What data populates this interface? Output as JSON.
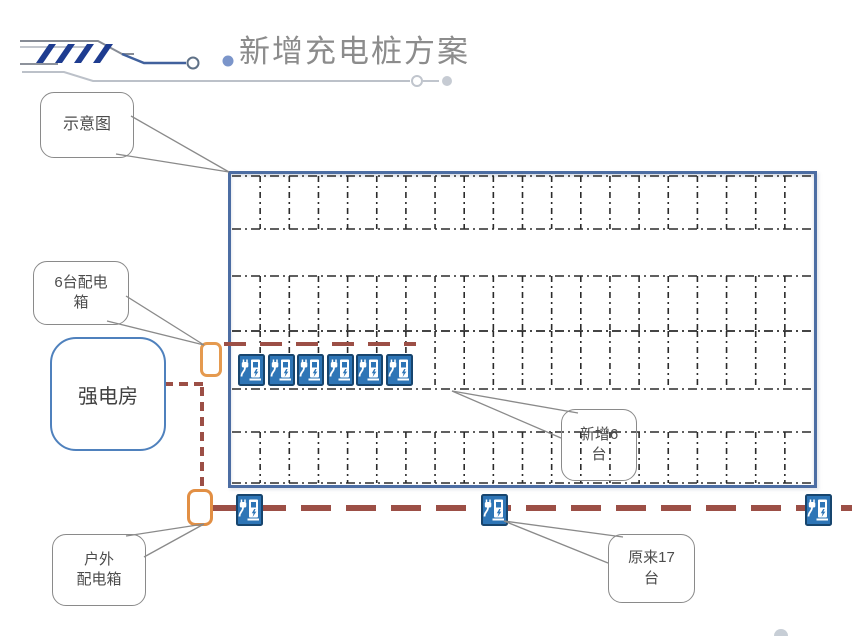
{
  "title": "新增充电桩方案",
  "callouts": {
    "schematic": {
      "label": "示意图"
    },
    "dist6": {
      "lines": [
        "6台配电",
        "箱"
      ]
    },
    "new6": {
      "lines": [
        "新增6",
        "台"
      ]
    },
    "orig17": {
      "lines": [
        "原来17",
        "台"
      ]
    },
    "outdoor": {
      "lines": [
        "户外",
        "配电箱"
      ]
    }
  },
  "power_room": {
    "label": "强电房"
  },
  "parking": {
    "cells_per_row": 20,
    "rows": [
      {
        "top": 2,
        "bottom": 55
      },
      {
        "top": 102,
        "bottom": 157
      },
      {
        "top": 157,
        "bottom": 215
      },
      {
        "top": 258,
        "bottom": 309
      }
    ],
    "new_piles": {
      "count": 6,
      "start_x": 238,
      "step": 29.5,
      "y": 354
    },
    "bottom_piles": {
      "xs": [
        236,
        481,
        805
      ],
      "y": 494
    }
  },
  "icons": {
    "charging_pile": "charging-station-sign",
    "distribution_box": "orange-rounded-box",
    "header": "circuit-lines-with-arrow-stripes"
  },
  "colors": {
    "title_gray": "#8c8c8c",
    "lot_border": "#4c6da3",
    "parking_line": "#2b2b2b",
    "power_line_red": "#9c4f46",
    "distribution_box_orange": "#e59a4f",
    "pile_fill": "#2e75b6",
    "pile_border": "#17456e",
    "stripe_navy": "#1e3c90",
    "accent_blue": "#4f81bd",
    "callout_border": "#8a8a8a"
  }
}
